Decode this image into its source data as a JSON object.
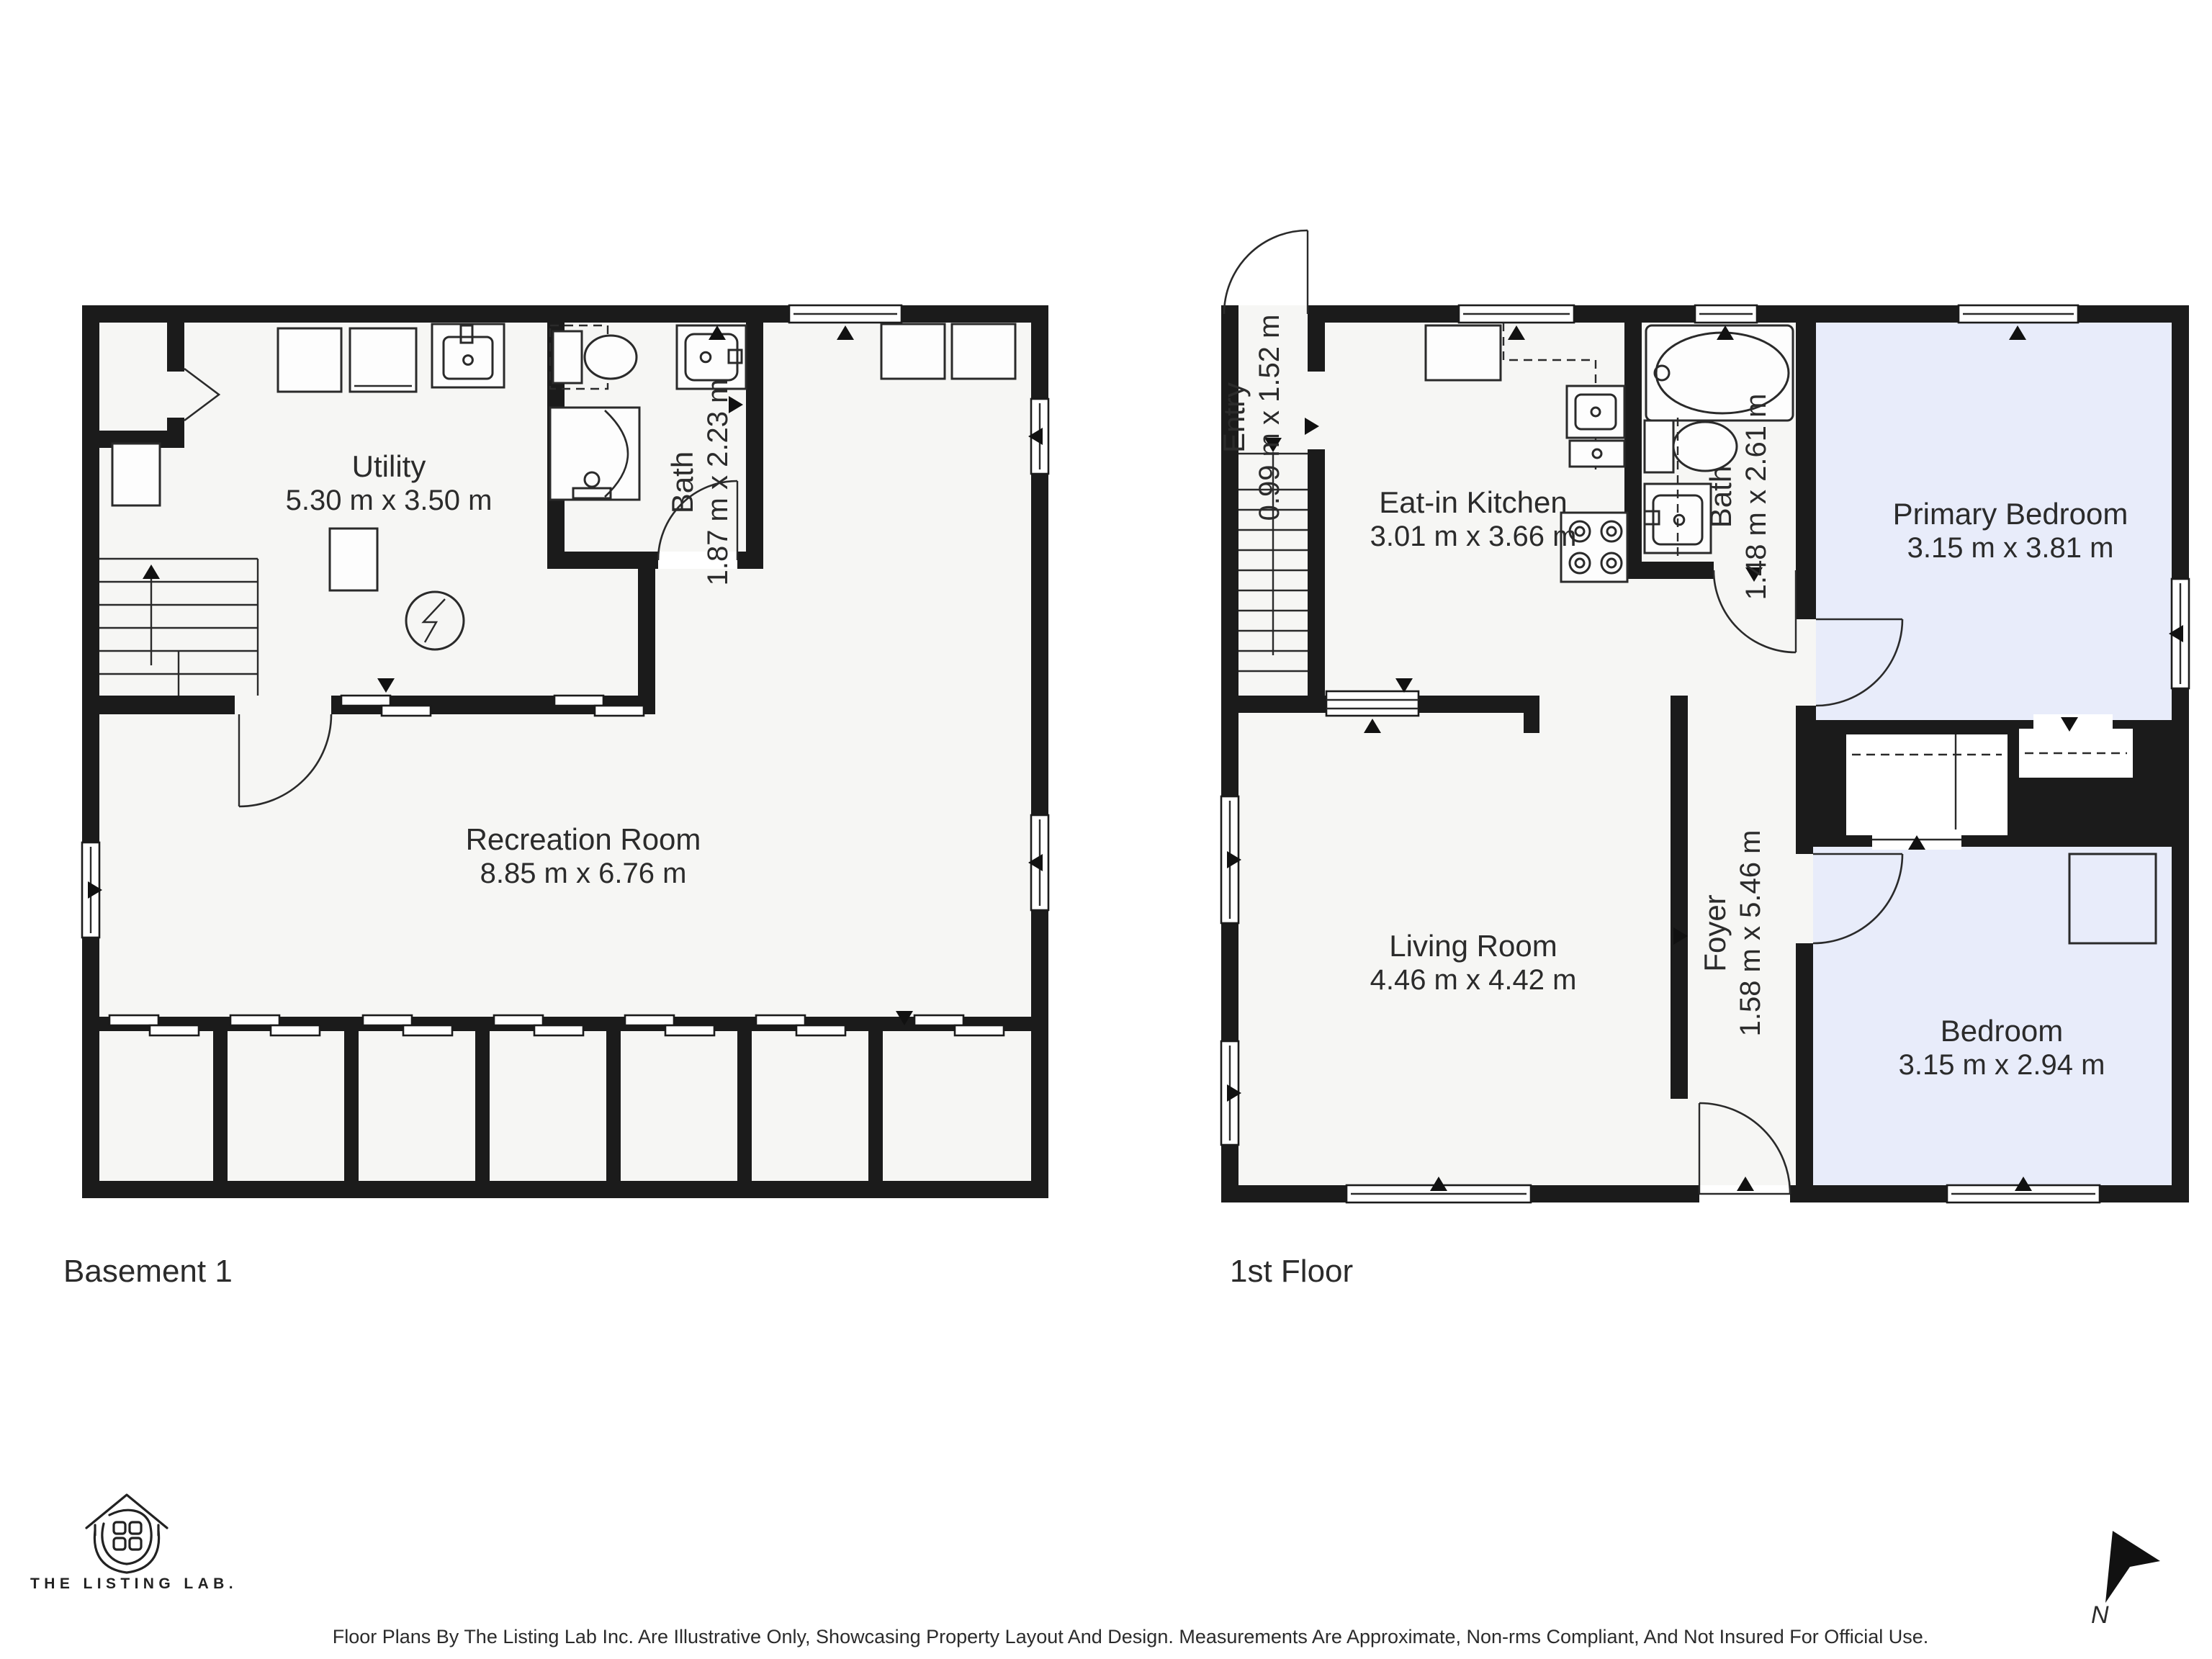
{
  "basement": {
    "title": "Basement 1",
    "rooms": {
      "utility": {
        "name": "Utility",
        "dims": "5.30 m x 3.50 m"
      },
      "bath": {
        "name": "Bath",
        "dims": "1.87 m x 2.23 m"
      },
      "recreation": {
        "name": "Recreation Room",
        "dims": "8.85 m x 6.76 m"
      }
    }
  },
  "first_floor": {
    "title": "1st Floor",
    "rooms": {
      "entry": {
        "name": "Entry",
        "dims": "0.99 m x 1.52 m"
      },
      "kitchen": {
        "name": "Eat-in Kitchen",
        "dims": "3.01 m x 3.66 m"
      },
      "bath": {
        "name": "Bath",
        "dims": "1.48 m x 2.61 m"
      },
      "primary_bedroom": {
        "name": "Primary Bedroom",
        "dims": "3.15 m x 3.81 m"
      },
      "foyer": {
        "name": "Foyer",
        "dims": "1.58 m x 5.46 m"
      },
      "living": {
        "name": "Living Room",
        "dims": "4.46 m x 4.42 m"
      },
      "bedroom": {
        "name": "Bedroom",
        "dims": "3.15 m x 2.94 m"
      }
    }
  },
  "footer": {
    "logo_text": "THE LISTING LAB.",
    "disclaimer": "Floor Plans By The Listing Lab Inc. Are Illustrative Only, Showcasing Property Layout And Design. Measurements Are Approximate, Non-rms Compliant, And Not Insured For Official Use.",
    "north_label": "N"
  },
  "colors": {
    "wall": "#1b1b1b",
    "floor": "#f6f6f4",
    "bedroom_fill": "#e8ecfa",
    "text": "#2b2b2b"
  }
}
